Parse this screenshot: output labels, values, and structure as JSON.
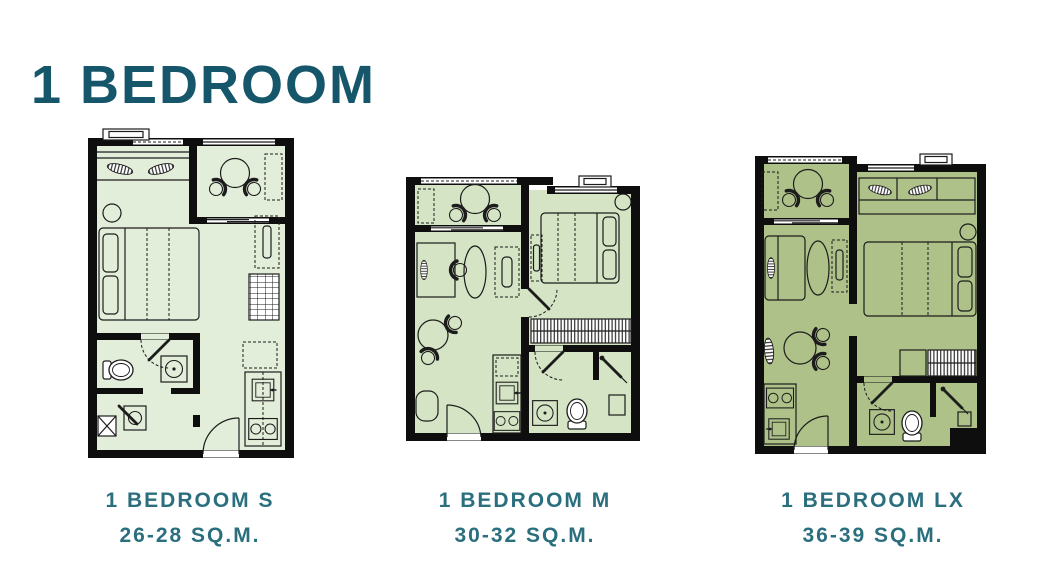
{
  "page": {
    "title": "1 BEDROOM"
  },
  "colors": {
    "title_text": "#15566b",
    "label_text": "#2b6f7f",
    "wall": "#0e0e0e",
    "plan_s_fill": "#e3eeda",
    "plan_m_fill": "#d4e4c4",
    "plan_lx_fill": "#aec189"
  },
  "plans": [
    {
      "id": "s",
      "name": "1 BEDROOM S",
      "area": "26-28 SQ.M."
    },
    {
      "id": "m",
      "name": "1 BEDROOM M",
      "area": "30-32 SQ.M."
    },
    {
      "id": "lx",
      "name": "1 BEDROOM LX",
      "area": "36-39 SQ.M."
    }
  ]
}
